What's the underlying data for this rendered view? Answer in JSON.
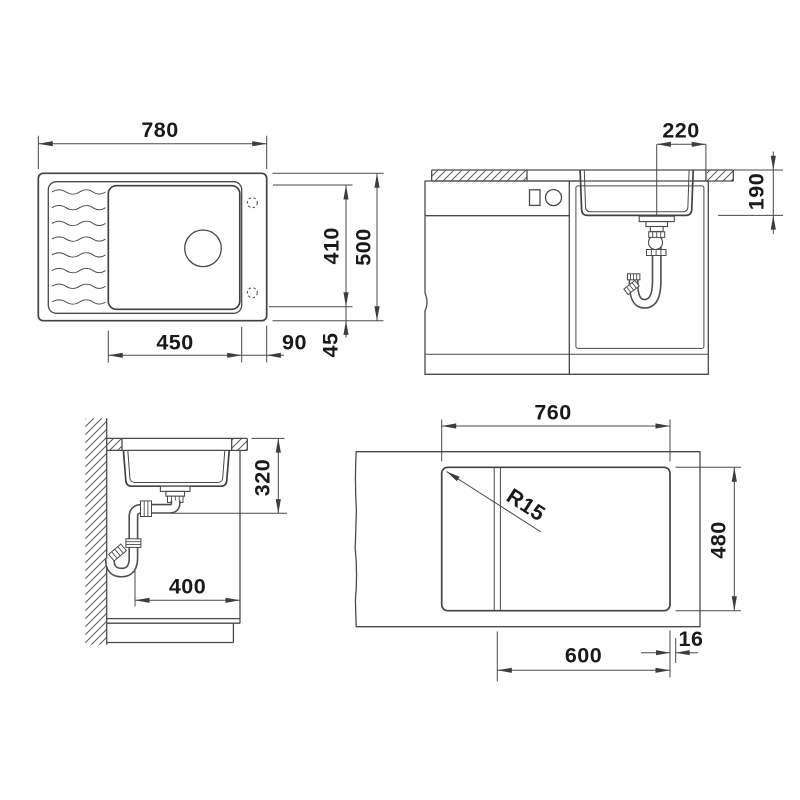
{
  "drawing_title": "sink-installation-technical-drawing",
  "colors": {
    "background": "#ffffff",
    "line": "#4a4a4a",
    "text": "#1a1a1a"
  },
  "views": {
    "plan": {
      "dims": {
        "width": "780",
        "depth": "500",
        "bowl_length": "410",
        "bowl_width": "450",
        "offset_right": "90",
        "offset_edge": "45"
      }
    },
    "front": {
      "dims": {
        "drain_offset": "220",
        "bowl_depth": "190"
      }
    },
    "side": {
      "dims": {
        "drain_height": "320",
        "drain_to_front": "400"
      }
    },
    "cutout": {
      "dims": {
        "width": "760",
        "depth": "480",
        "cabinet_width": "600",
        "panel_thickness": "16",
        "corner_radius": "R15"
      }
    }
  }
}
